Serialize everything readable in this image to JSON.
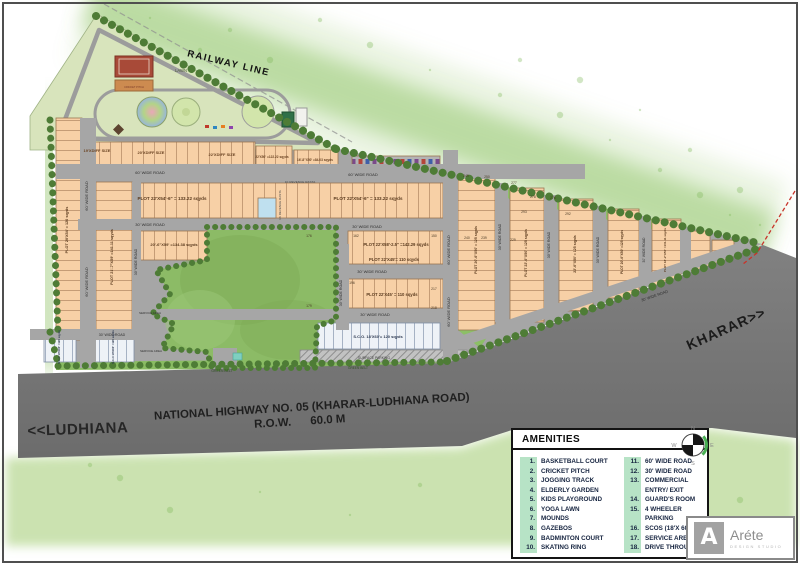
{
  "colors": {
    "plot_fill": "#f7d0a6",
    "plot_line": "#b9906a",
    "road": "#a6a6a6",
    "highway": "#767676",
    "park": "#8cbb66",
    "mint": "#b7e3c6",
    "sco_fill": "#eef2f7",
    "tree": "#4e7c36",
    "boundary_red": "#c8342a"
  },
  "map": {
    "labels": [
      {
        "t": "RAILWAY LINE",
        "x": 228,
        "y": 66,
        "r": 13.5,
        "s": 9.5,
        "w": 700,
        "ls": 1.5,
        "c": "#111111"
      },
      {
        "t": "LAWN",
        "x": 181,
        "y": 72,
        "s": 4.2,
        "c": "#4c5c38"
      },
      {
        "t": "CRICKET PITCH",
        "x": 134,
        "y": 88,
        "s": 2.6,
        "c": "#7a3b2a"
      },
      {
        "t": "19'XDIFF SIZE",
        "x": 97,
        "y": 152,
        "s": 4,
        "w": 700,
        "c": "#6b4423"
      },
      {
        "t": "20'XDIFF SIZE",
        "x": 151,
        "y": 154,
        "s": 4,
        "w": 700,
        "c": "#6b4423"
      },
      {
        "t": "22'XDIFF SIZE",
        "x": 222,
        "y": 156,
        "s": 4,
        "w": 700,
        "c": "#6b4423"
      },
      {
        "t": "22'X50' =122.22 sqyds",
        "x": 272,
        "y": 158,
        "s": 3.2,
        "w": 700,
        "c": "#6b4423"
      },
      {
        "t": "16'-8\"X50' =84.03 sqyds",
        "x": 315,
        "y": 161,
        "s": 3.2,
        "w": 700,
        "c": "#6b4423"
      },
      {
        "t": "60' WIDE ROAD",
        "x": 150,
        "y": 174,
        "s": 4,
        "c": "#2e2e2e"
      },
      {
        "t": "60' WIDE ROAD",
        "x": 363,
        "y": 176,
        "s": 4,
        "c": "#2e2e2e"
      },
      {
        "t": "1K REVENUE RASTA",
        "x": 300,
        "y": 183,
        "s": 3.1,
        "c": "#444444"
      },
      {
        "t": "PLOT 22'X54'-6\" = 133.22 sqyds",
        "x": 172,
        "y": 200,
        "s": 4.6,
        "w": 700,
        "c": "#5a3a1e"
      },
      {
        "t": "PLOT 22'X54'-6\" = 133.22 sqyds",
        "x": 368,
        "y": 200,
        "s": 4.6,
        "w": 700,
        "c": "#5a3a1e"
      },
      {
        "t": "30' WIDE ROAD",
        "x": 150,
        "y": 226,
        "s": 4,
        "c": "#2e2e2e"
      },
      {
        "t": "30' WIDE ROAD",
        "x": 367,
        "y": 228,
        "s": 4,
        "c": "#2e2e2e"
      },
      {
        "t": "20'-6\"X59' =134.38 sqyds",
        "x": 174,
        "y": 246,
        "s": 4,
        "w": 700,
        "c": "#5a3a1e"
      },
      {
        "t": "PLOT 22'X58'-2.5\" =142.29 sqyds",
        "x": 396,
        "y": 246,
        "s": 4.2,
        "w": 700,
        "c": "#5a3a1e"
      },
      {
        "t": "PLOT 22'X45'= 110 sqyds",
        "x": 394,
        "y": 261,
        "s": 4.2,
        "w": 700,
        "c": "#5a3a1e"
      },
      {
        "t": "30' WIDE ROAD",
        "x": 372,
        "y": 273,
        "s": 4,
        "c": "#2e2e2e"
      },
      {
        "t": "PLOT 22'X45' = 110 sqyds",
        "x": 392,
        "y": 296,
        "s": 4.2,
        "w": 700,
        "c": "#5a3a1e"
      },
      {
        "t": "30' WIDE ROAD",
        "x": 375,
        "y": 316,
        "s": 4,
        "c": "#2e2e2e"
      },
      {
        "t": "S.C.O. 18'X60'= 120 sqyds",
        "x": 378,
        "y": 338,
        "s": 4,
        "w": 700,
        "c": "#2e3a52"
      },
      {
        "t": "SURFACE PARKING",
        "x": 374,
        "y": 359,
        "s": 3.4,
        "c": "#3c3c3c"
      },
      {
        "t": "GREEN BELT",
        "x": 222,
        "y": 372,
        "s": 3.4,
        "c": "#2f4d22"
      },
      {
        "t": "GREEN BELT",
        "x": 358,
        "y": 369,
        "s": 3.2,
        "c": "#2f4d22"
      },
      {
        "t": "30' WIDE ROAD",
        "x": 112,
        "y": 336,
        "s": 3.6,
        "c": "#2e2e2e"
      },
      {
        "t": "SERVICE AREA",
        "x": 150,
        "y": 314,
        "s": 3,
        "c": "#333333"
      },
      {
        "t": "SERVICE AREA",
        "x": 151,
        "y": 352,
        "s": 3,
        "c": "#333333"
      },
      {
        "t": "S.C.O 18'X60' =120 sqyds",
        "x": 60,
        "y": 347,
        "r": -90,
        "s": 2.8,
        "w": 700,
        "c": "#2e3a52"
      },
      {
        "t": "S.C.O 18'X60' =120 sqyds",
        "x": 114,
        "y": 347,
        "r": -90,
        "s": 2.8,
        "w": 700,
        "c": "#2e3a52"
      },
      {
        "t": "60' WIDE ROAD",
        "x": 88,
        "y": 196,
        "r": -90,
        "s": 4,
        "c": "#2e2e2e"
      },
      {
        "t": "60' WIDE ROAD",
        "x": 88,
        "y": 282,
        "r": -90,
        "s": 4,
        "c": "#2e2e2e"
      },
      {
        "t": "PLOT 20'X54' = 120 sqyds",
        "x": 68,
        "y": 230,
        "r": -90,
        "s": 3.8,
        "w": 700,
        "c": "#5a3a1e"
      },
      {
        "t": "PLOT 21'-7\"X59' =141.11 sqyds",
        "x": 113,
        "y": 257,
        "r": -90,
        "s": 3.8,
        "w": 700,
        "c": "#5a3a1e"
      },
      {
        "t": "30' WIDE ROAD",
        "x": 137,
        "y": 262,
        "r": -90,
        "s": 3.6,
        "c": "#2e2e2e"
      },
      {
        "t": "1K REVENUE RASTA",
        "x": 281,
        "y": 205,
        "r": -90,
        "s": 3,
        "c": "#444444"
      },
      {
        "t": "30' WIDE ROAD",
        "x": 342,
        "y": 293,
        "r": -90,
        "s": 3.6,
        "c": "#2e2e2e"
      },
      {
        "t": "60' WIDE ROAD",
        "x": 450,
        "y": 250,
        "r": -90,
        "s": 4,
        "c": "#2e2e2e"
      },
      {
        "t": "60' WIDE ROAD",
        "x": 450,
        "y": 312,
        "r": -90,
        "s": 4,
        "c": "#2e2e2e"
      },
      {
        "t": "PLOT 20'-6\"X50' = 125 sqyds",
        "x": 477,
        "y": 250,
        "r": -90,
        "s": 3.5,
        "w": 700,
        "c": "#5a3a1e"
      },
      {
        "t": "30' WIDE ROAD",
        "x": 501,
        "y": 237,
        "r": -90,
        "s": 3.6,
        "c": "#2e2e2e"
      },
      {
        "t": "PLOT 22'-6\"X50' = 125 sqyds",
        "x": 527,
        "y": 253,
        "r": -90,
        "s": 3.5,
        "w": 700,
        "c": "#5a3a1e"
      },
      {
        "t": "30' WIDE ROAD",
        "x": 550,
        "y": 245,
        "r": -90,
        "s": 3.6,
        "c": "#2e2e2e"
      },
      {
        "t": "22'-6\"X50' = 125 sqyds",
        "x": 576,
        "y": 254,
        "r": -90,
        "s": 3.5,
        "w": 700,
        "c": "#5a3a1e"
      },
      {
        "t": "30' WIDE ROAD",
        "x": 599,
        "y": 250,
        "r": -90,
        "s": 3.6,
        "c": "#2e2e2e"
      },
      {
        "t": "PLOT 20'-6\"X50' =125 sqyds",
        "x": 623,
        "y": 252,
        "r": -90,
        "s": 3.3,
        "w": 700,
        "c": "#5a3a1e"
      },
      {
        "t": "30' WIDE ROAD",
        "x": 645,
        "y": 250,
        "r": -90,
        "s": 3.4,
        "c": "#2e2e2e"
      },
      {
        "t": "PLOT 18'-2\"X50' =101.11 sqyds",
        "x": 666,
        "y": 250,
        "r": -90,
        "s": 3,
        "w": 700,
        "c": "#5a3a1e"
      },
      {
        "t": "30' WIDE ROAD",
        "x": 655,
        "y": 297,
        "r": -19,
        "s": 3.8,
        "c": "#2e2e2e"
      },
      {
        "t": "KHARAR>>",
        "x": 728,
        "y": 333,
        "r": -24,
        "s": 14,
        "w": 700,
        "ls": 1,
        "c": "#1b1b1b"
      },
      {
        "t": "<<LUDHIANA",
        "x": 78,
        "y": 434,
        "r": -2,
        "s": 15,
        "w": 600,
        "ls": 0.5,
        "c": "#262626"
      },
      {
        "t": "NATIONAL HIGHWAY NO. 05 (KHARAR-LUDHIANA ROAD)",
        "x": 312,
        "y": 410,
        "r": -3.5,
        "s": 11.5,
        "w": 700,
        "c": "#1f1f1f"
      },
      {
        "t": "R.O.W.      60.0 M",
        "x": 300,
        "y": 425,
        "r": -3.5,
        "s": 11.5,
        "w": 700,
        "c": "#1f1f1f"
      }
    ],
    "plot_numbers": [
      {
        "n": "176",
        "x": 309,
        "y": 237
      },
      {
        "n": "162",
        "x": 356,
        "y": 237
      },
      {
        "n": "150",
        "x": 434,
        "y": 237
      },
      {
        "n": "240",
        "x": 467,
        "y": 239
      },
      {
        "n": "239",
        "x": 484,
        "y": 239
      },
      {
        "n": "229",
        "x": 513,
        "y": 241
      },
      {
        "n": "196",
        "x": 352,
        "y": 284
      },
      {
        "n": "217",
        "x": 434,
        "y": 290
      },
      {
        "n": "179",
        "x": 309,
        "y": 307
      },
      {
        "n": "218",
        "x": 434,
        "y": 309
      },
      {
        "n": "249",
        "x": 466,
        "y": 177
      },
      {
        "n": "250",
        "x": 487,
        "y": 178
      },
      {
        "n": "277",
        "x": 514,
        "y": 184
      },
      {
        "n": "278",
        "x": 533,
        "y": 198
      },
      {
        "n": "276",
        "x": 553,
        "y": 199
      },
      {
        "n": "293",
        "x": 524,
        "y": 213
      },
      {
        "n": "292",
        "x": 568,
        "y": 215
      }
    ]
  },
  "amenities": {
    "title": "AMENITIES",
    "col1": [
      {
        "num": "1.",
        "label": "BASKETBALL COURT"
      },
      {
        "num": "2.",
        "label": "CRICKET PITCH"
      },
      {
        "num": "3.",
        "label": "JOGGING TRACK"
      },
      {
        "num": "4.",
        "label": "ELDERLY GARDEN"
      },
      {
        "num": "5.",
        "label": "KIDS PLAYGROUND"
      },
      {
        "num": "6.",
        "label": "YOGA LAWN"
      },
      {
        "num": "7.",
        "label": "MOUNDS"
      },
      {
        "num": "8.",
        "label": "GAZEBOS"
      },
      {
        "num": "9.",
        "label": "BADMINTON COURT"
      },
      {
        "num": "10.",
        "label": "SKATING RING"
      }
    ],
    "col2": [
      {
        "num": "11.",
        "label": "60' WIDE ROAD"
      },
      {
        "num": "12.",
        "label": "30' WIDE ROAD"
      },
      {
        "num": "13.",
        "label": "COMMERCIAL\nENTRY/ EXIT"
      },
      {
        "num": "14.",
        "label": "GUARD'S ROOM"
      },
      {
        "num": "15.",
        "label": "4 WHEELER\nPARKING"
      },
      {
        "num": "16.",
        "label": "SCOS (18'X 60')"
      },
      {
        "num": "17.",
        "label": "SERVICE AREA"
      },
      {
        "num": "18.",
        "label": "DRIVE THROUGH"
      }
    ]
  },
  "compass": {
    "n": "N",
    "e": "E",
    "s": "S",
    "w": "W"
  },
  "logo": {
    "mark": "A",
    "name": "Aréte",
    "sub": "DESIGN STUDIO"
  }
}
